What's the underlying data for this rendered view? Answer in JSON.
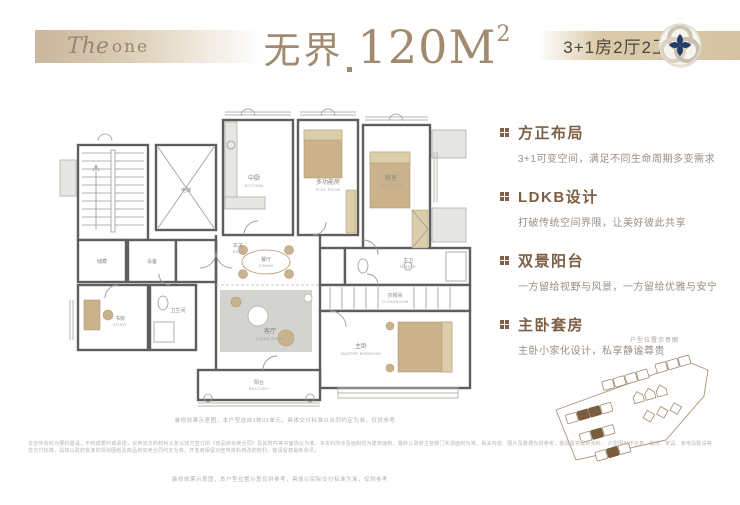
{
  "header": {
    "brand_the": "The",
    "brand_one": "one",
    "title_cn": "无界",
    "title_num": "120M",
    "title_sup": "2",
    "spec": "3+1房2厅2卫"
  },
  "features": [
    {
      "title": "方正布局",
      "desc": "3+1可变空间，满足不同生命周期多变需求"
    },
    {
      "title": "LDKB设计",
      "desc": "打破传统空间界限，让美好彼此共享"
    },
    {
      "title": "双景阳台",
      "desc": "一方留给视野与风景，一方留给优雅与安宁"
    },
    {
      "title": "主卧套房",
      "desc": "主卧小家化设计，私享静谧尊贵"
    }
  ],
  "plan": {
    "rooms": {
      "elevator": {
        "cn": "电梯",
        "en": "ELEV."
      },
      "kitchen": {
        "cn": "中厨",
        "en": "KITCHEN"
      },
      "flex": {
        "cn": "多功能房",
        "en": "FLEX ROOM"
      },
      "bedroom2": {
        "cn": "卧室",
        "en": "BED ROOM"
      },
      "store1": {
        "cn": "储藏",
        "en": ""
      },
      "store2": {
        "cn": "设备",
        "en": ""
      },
      "hall": {
        "cn": "玄关",
        "en": "HALL"
      },
      "dining": {
        "cn": "餐厅",
        "en": "DINING"
      },
      "living": {
        "cn": "客厅",
        "en": "LIVING ROOM"
      },
      "masterbath": {
        "cn": "主卫",
        "en": "M.BATH"
      },
      "cloak": {
        "cn": "衣帽间",
        "en": "CLOAKROOM"
      },
      "master": {
        "cn": "主卧",
        "en": "MASTER BEDROOM"
      },
      "study": {
        "cn": "书房",
        "en": "STUDY"
      },
      "bath2": {
        "cn": "卫生间",
        "en": "BATH"
      },
      "balcony": {
        "cn": "阳台",
        "en": "BALCONY"
      }
    },
    "caption": "装修效果示意图，本户型选自1栋01单元，具体交付标准以合同约定为准，仅供参考"
  },
  "siteplan": {
    "label": "户型位置示意图"
  },
  "footer": {
    "line1": "本宣传资料为要约邀请，不构成要约或承诺，买卖双方的权利义务以双方签订的《商品房买卖合同》及其附件等书面协议为准。本资料所涉及面积均为建筑面积，最终以政府主管部门实测面积为准。相关内容、图片及数据仅供参考，敬请留意最新资料。",
    "line2": "户型图仅作示意，装修、家具、家电及陈设等非交付标准，具体以政府批准的规划图纸及商品房买卖合同约定为准。开发商保留对宣传资料修改的权利，敬请留意最新资讯。",
    "line3": "装修效果示意图，本户型位置示意仅供参考，具体以实际交付标准为准，仅供参考"
  },
  "colors": {
    "accent_brown": "#7c5f45",
    "band_beige": "#d5c3a2",
    "title_taupe": "#a18a6e",
    "seal_navy": "#223d6b"
  }
}
